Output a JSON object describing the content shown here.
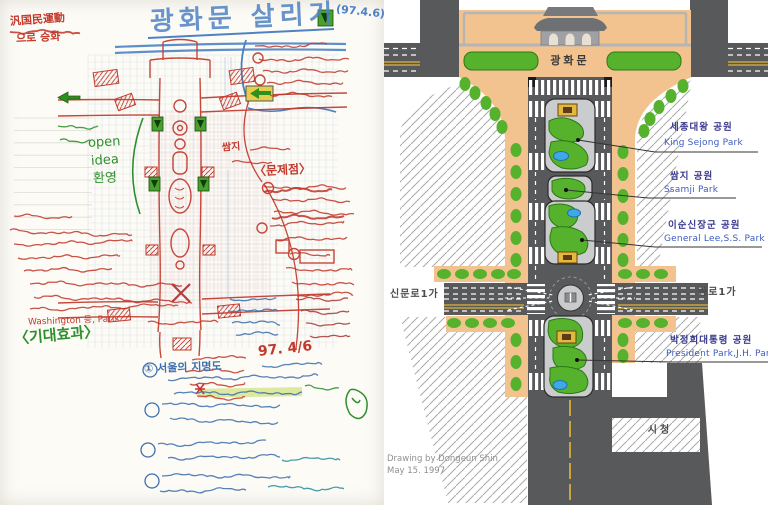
{
  "left_sketch": {
    "title": "광화문 살리기",
    "title_date": "(97.4.6)",
    "note_pan_national_1": "汎国民運動",
    "note_pan_national_2": "으로 승화",
    "open_note_1": "open",
    "open_note_2": "idea",
    "open_note_3": "환영",
    "ssamji_note": "쌈지",
    "problems_header": "〈문제점〉",
    "effects_header": "〈기대효과〉",
    "cities_line": "Washington 등, Paris",
    "date_note": "97. 4/6",
    "seoul_note": "① 서울의 지명도",
    "ink_colors": {
      "red": "#c2392c",
      "blue": "#3f6fae",
      "green": "#2f8f2f",
      "title_blue": "#4f82c4"
    }
  },
  "right_plan": {
    "gate_label": "광화문",
    "parks": [
      {
        "kr": "세종대왕 공원",
        "en": "King Sejong Park"
      },
      {
        "kr": "쌈지 공원",
        "en": "Ssamji Park"
      },
      {
        "kr": "이순신장군 공원",
        "en": "General Lee,S.S. Park"
      },
      {
        "kr": "박정희대통령 공원",
        "en": "President Park,J.H. Park"
      }
    ],
    "road_left": "신문로1가",
    "road_right": "종로1가",
    "city_hall": "시청",
    "credit_line1": "Drawing by Dongeun Shin",
    "credit_line2": "May 15. 1997",
    "colors": {
      "plaza_peach": "#f2c38f",
      "road_gray": "#58595b",
      "park_green": "#56b22c",
      "island_gray": "#cbcccd",
      "pond_blue": "#3fa9e8",
      "lane_yellow": "#c9a53e"
    }
  }
}
